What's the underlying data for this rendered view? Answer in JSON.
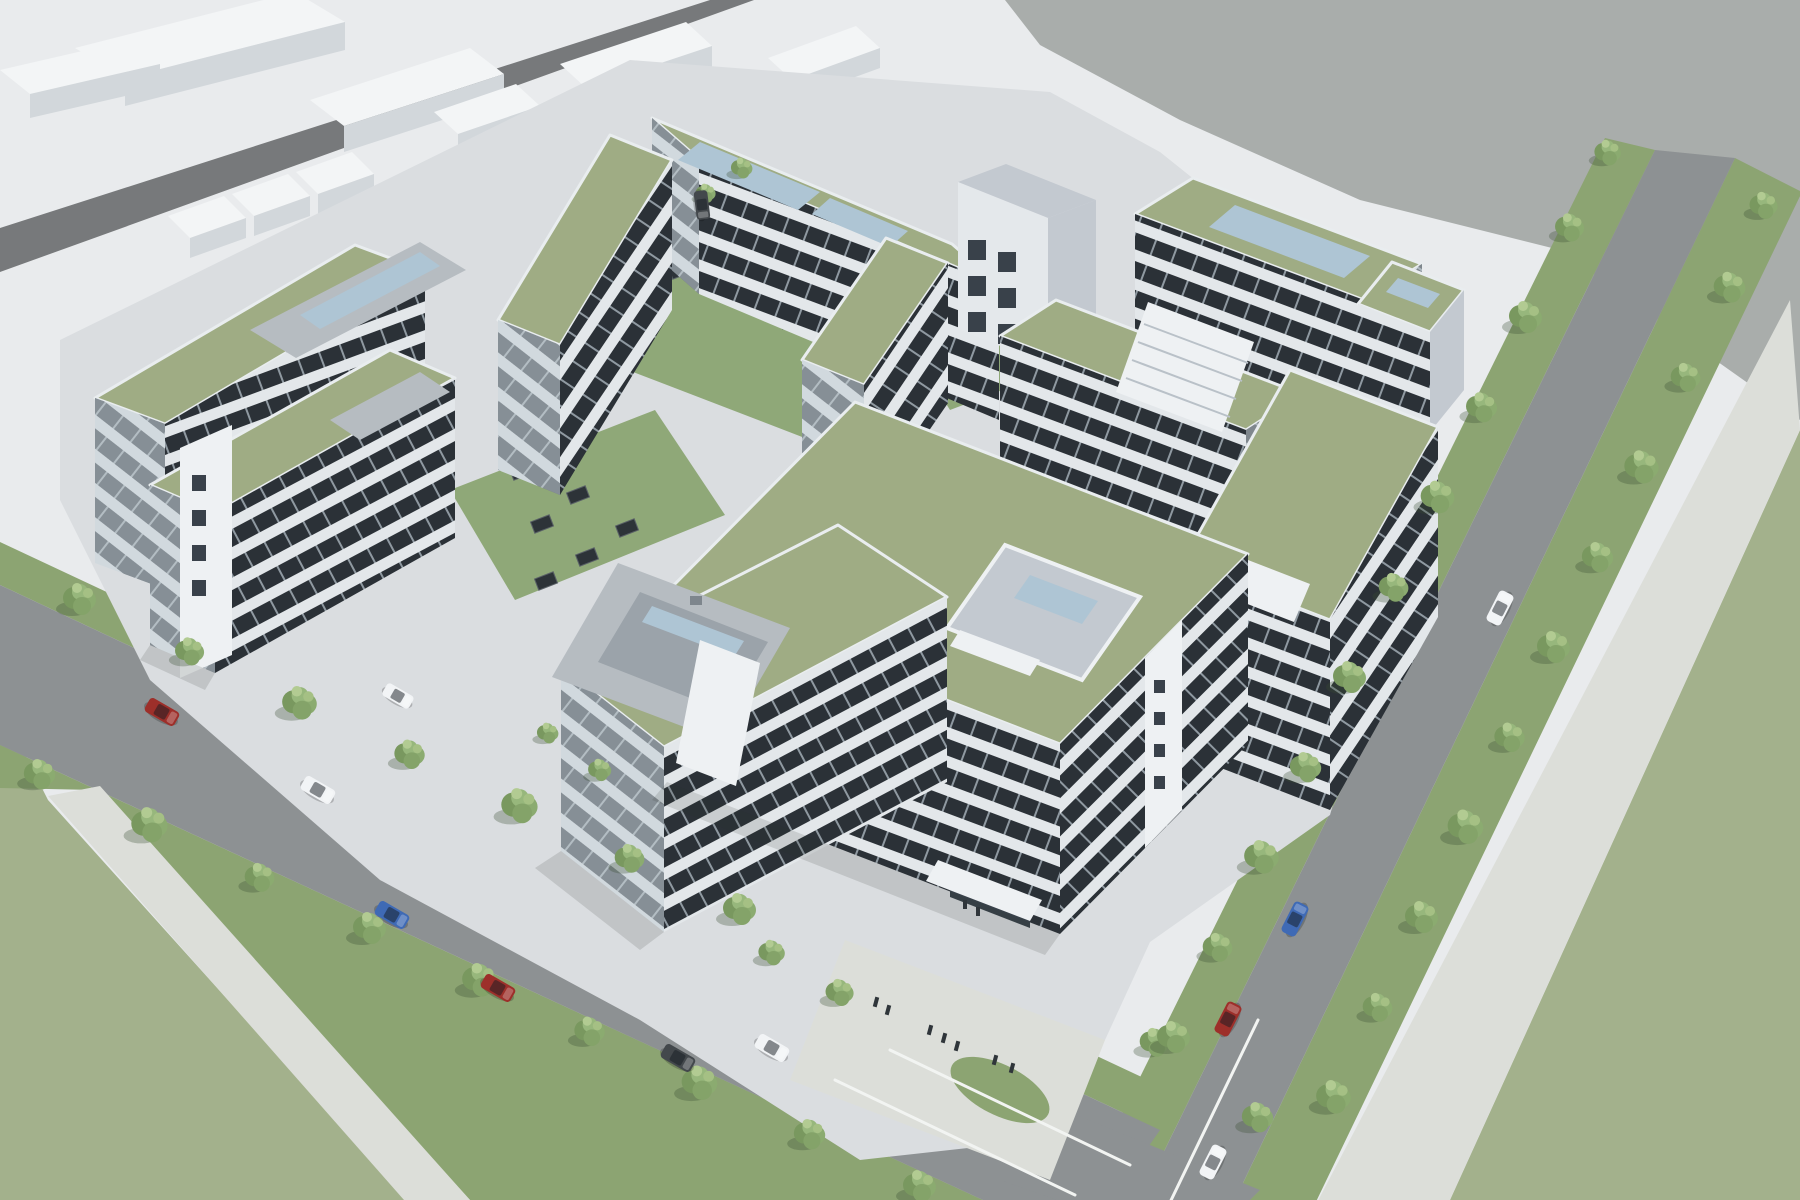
{
  "meta": {
    "title": "Aerial 3D architectural rendering of an office campus",
    "type": "3d-architectural-visualization",
    "view": "high-angle aerial oblique",
    "time_of_day": "daytime, neutral overcast light"
  },
  "palette": {
    "ground": "#e9ebed",
    "backdrop": "#a9adab",
    "campus_ground": "#dadde0",
    "sidewalk": "#dcded9",
    "road": "#8d9193",
    "road_dark": "#77797b",
    "verge": "#8ca472",
    "lawn": "#8fa878",
    "field": "#a3b18c",
    "roof_green": "#9fac84",
    "facade_light": "#e4e8eb",
    "facade_shadow": "#c3c9d0",
    "window_dark": "#2b3137",
    "glass_blue": "#aec5d4",
    "mech_grey": "#b6bcc1",
    "white_block": "#f3f5f6",
    "white_block_side": "#d2d7db",
    "tree_canopy": "#84a369",
    "asphalt_marking": "#f2f4f2"
  },
  "scene": {
    "background": {
      "backdrop": "flat grey unrendered canvas, top-right",
      "context_ground": "pale white ground plane with abstract massing blocks, top-left"
    },
    "context": {
      "massing_blocks": 9,
      "context_road": "dark diagonal road"
    },
    "campus": {
      "office_buildings": 10,
      "floors_range": "4-7",
      "roof_type": "extensive sage-green roofs with grey parapets",
      "facade": "light metal bands with dark ribbon windows",
      "rooftop_structures": [
        "blue-glass skylight boxes",
        "grey mechanical penthouse",
        "roof terrace with glass pavilion",
        "white stair towers"
      ],
      "courtyards": 3,
      "courtyard_skylights": 10,
      "courtyard_cars": 5
    },
    "streets": {
      "main_boulevard": "runs lower-left, lined with trees",
      "side_street": "runs along right edge toward intersection",
      "intersection": "bottom-center with white lane markings",
      "walkway": "light pedestrian path, bottom-left"
    },
    "cars": [
      {
        "id": "car-red-1",
        "color": "#9d2f2a",
        "location": "main boulevard upper"
      },
      {
        "id": "car-white-1",
        "color": "#f2f4f6",
        "location": "main boulevard"
      },
      {
        "id": "car-blue-1",
        "color": "#3f6ab5",
        "location": "main boulevard"
      },
      {
        "id": "car-red-2",
        "color": "#9d2f2a",
        "location": "main boulevard"
      },
      {
        "id": "car-grey-1",
        "color": "#43484c",
        "location": "main boulevard near intersection"
      },
      {
        "id": "car-white-2",
        "color": "#f2f4f6",
        "location": "main boulevard near intersection"
      },
      {
        "id": "car-white-3",
        "color": "#f2f4f6",
        "location": "side street upper"
      },
      {
        "id": "car-blue-2",
        "color": "#3f6ab5",
        "location": "side street"
      },
      {
        "id": "car-red-3",
        "color": "#9d2f2a",
        "location": "side street lower"
      },
      {
        "id": "car-white-4",
        "color": "#f2f4f6",
        "location": "side street at intersection"
      },
      {
        "id": "car-white-parked",
        "color": "#f2f4f6",
        "location": "campus drive parked"
      },
      {
        "id": "car-grey-parked",
        "color": "#43484c",
        "location": "context drive parked"
      }
    ],
    "pedestrians": {
      "count": 9,
      "location": "entrance plaza at bottom intersection corner"
    },
    "landscape": {
      "street_trees": 46,
      "field": "large sage-green fields bottom-right and bottom-left"
    }
  }
}
